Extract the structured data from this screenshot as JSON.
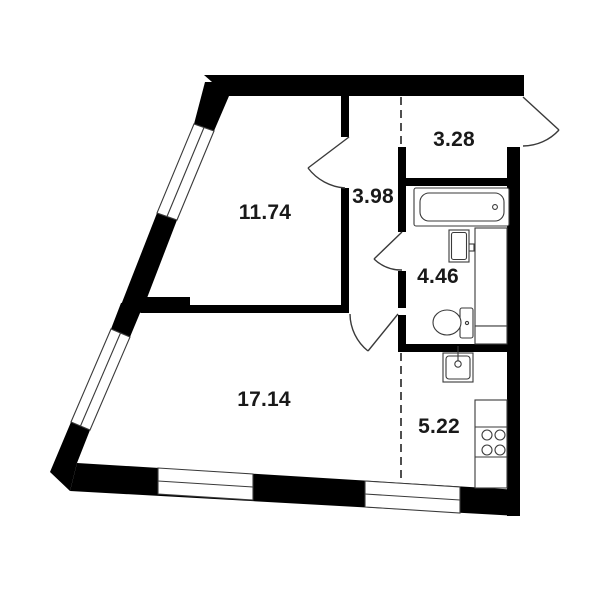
{
  "title": "apartment floor plan",
  "colors": {
    "background": "#ffffff",
    "walls": "#000000",
    "lines": "#3a3a3a",
    "dashed": "#3c3c3c",
    "label_text": "#191919"
  },
  "rooms": [
    {
      "id": "room-11-74",
      "label": "11.74"
    },
    {
      "id": "hall-3-98",
      "label": "3.98"
    },
    {
      "id": "entry-3-28",
      "label": "3.28"
    },
    {
      "id": "bath-4-46",
      "label": "4.46"
    },
    {
      "id": "room-17-14",
      "label": "17.14"
    },
    {
      "id": "kitchen-5-22",
      "label": "5.22"
    }
  ]
}
